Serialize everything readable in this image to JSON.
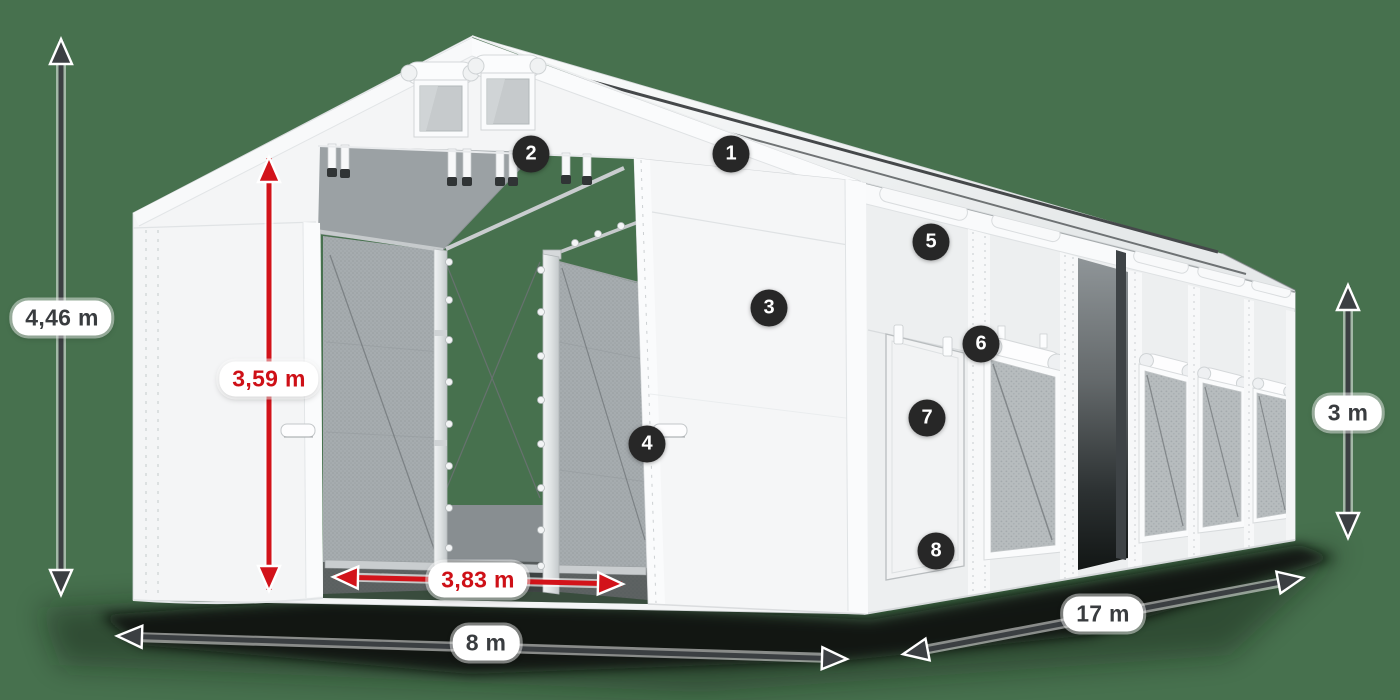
{
  "illustration": {
    "alt": "White PVC storage tent shown in perspective with open front entrance, side door, mesh windows, red and dark dimension arrows and eight numbered feature markers"
  },
  "dimensions": {
    "total_height": {
      "value": "4,46 m",
      "color": "dark",
      "meaning": "overall height at gable peak"
    },
    "entrance_height": {
      "value": "3,59 m",
      "color": "red",
      "meaning": "clear entrance height"
    },
    "entrance_width": {
      "value": "3,83 m",
      "color": "red",
      "meaning": "clear entrance width"
    },
    "width": {
      "value": "8 m",
      "color": "dark",
      "meaning": "tent width (front)"
    },
    "length": {
      "value": "17 m",
      "color": "dark",
      "meaning": "tent length (side)"
    },
    "side_height": {
      "value": "3 m",
      "color": "dark",
      "meaning": "side wall height"
    }
  },
  "markers": [
    {
      "number": "1"
    },
    {
      "number": "2"
    },
    {
      "number": "3"
    },
    {
      "number": "4"
    },
    {
      "number": "5"
    },
    {
      "number": "6"
    },
    {
      "number": "7"
    },
    {
      "number": "8"
    }
  ],
  "colors": {
    "background": "#47714E",
    "dimension_dark": "#3b3f42",
    "dimension_red": "#d2131a",
    "label_background": "#ffffff",
    "label_text_dark": "#393c3f",
    "label_text_red": "#ce1017",
    "marker_background": "#272727",
    "marker_text": "#ffffff",
    "tent_fabric": "#f5f6f7"
  }
}
